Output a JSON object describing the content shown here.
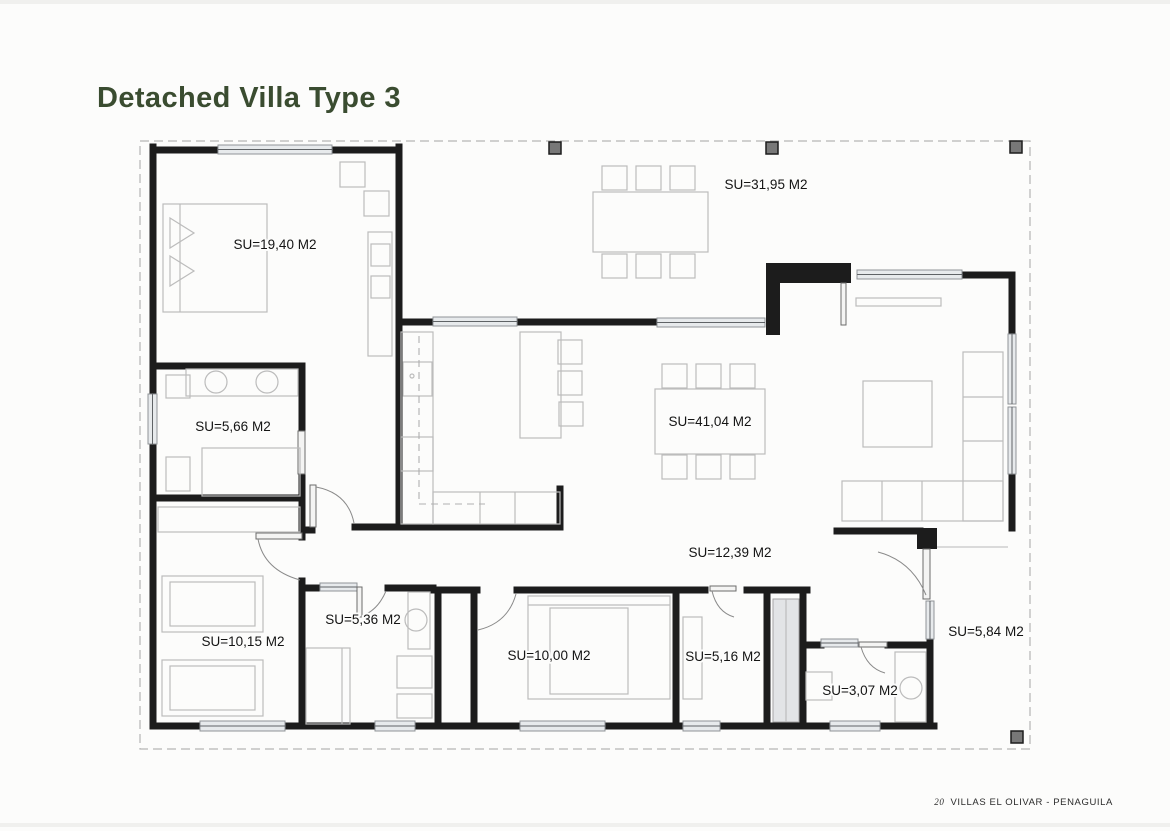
{
  "page": {
    "title": "Detached Villa Type 3",
    "footer": {
      "page_number": "20",
      "project_name": "VILLAS EL OLIVAR - PENAGUILA"
    }
  },
  "colors": {
    "title_green": "#3a4c30",
    "wall": "#1c1c1c",
    "furniture_gray": "#bcbcbc",
    "window_fill": "#e7eaec",
    "column_fill": "#787878",
    "boundary_dash": "#b5b5b5"
  },
  "floor_plan": {
    "drawing_type": "architectural floor plan",
    "rooms": [
      {
        "id": "master-bedroom",
        "area_label": "SU=19,40 M2"
      },
      {
        "id": "terrace",
        "area_label": "SU=31,95 M2"
      },
      {
        "id": "bathroom-1",
        "area_label": "SU=5,66 M2"
      },
      {
        "id": "living-dining",
        "area_label": "SU=41,04 M2"
      },
      {
        "id": "hallway",
        "area_label": "SU=12,39 M2"
      },
      {
        "id": "bedroom-2",
        "area_label": "SU=10,15 M2"
      },
      {
        "id": "bathroom-2",
        "area_label": "SU=5,36 M2"
      },
      {
        "id": "bedroom-3",
        "area_label": "SU=10,00 M2"
      },
      {
        "id": "dressing-room",
        "area_label": "SU=5,16 M2"
      },
      {
        "id": "bathroom-3",
        "area_label": "SU=3,07 M2"
      },
      {
        "id": "entry-porch",
        "area_label": "SU=5,84 M2"
      }
    ]
  }
}
